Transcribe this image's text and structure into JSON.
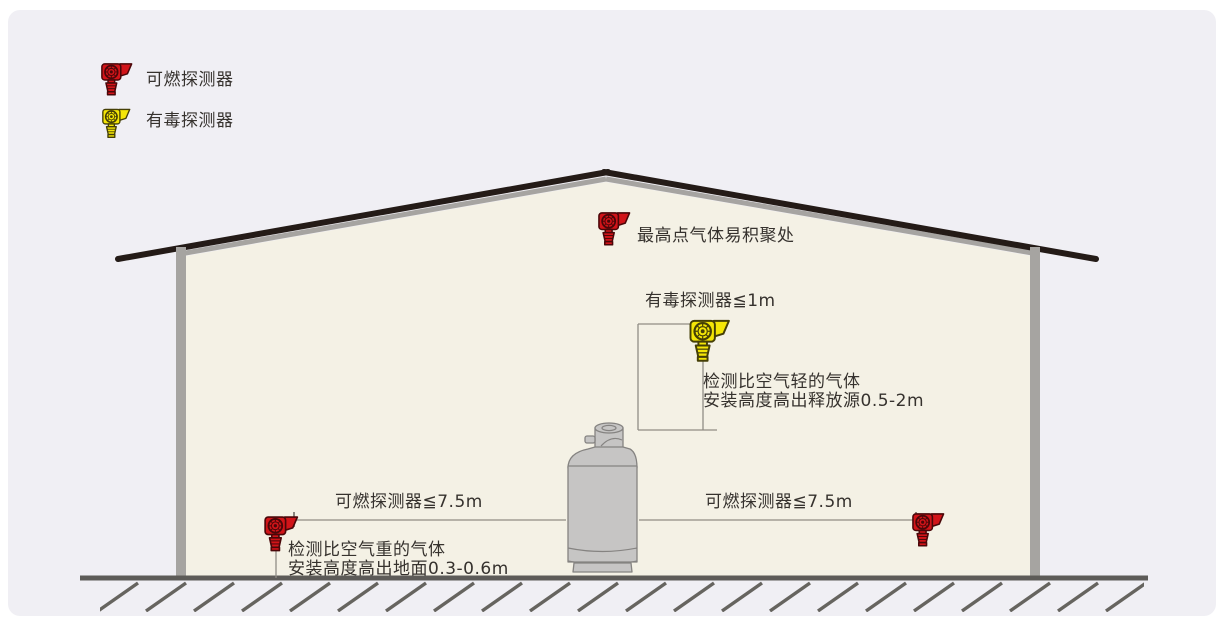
{
  "legend": {
    "combustible_label": "可燃探测器",
    "toxic_label": "有毒探测器"
  },
  "labels": {
    "peak_note": "最高点气体易积聚处",
    "toxic_detector_distance": "有毒探测器≦1m",
    "light_gas_note_line1": "检测比空气轻的气体",
    "light_gas_note_line2": "安装高度高出释放源0.5-2m",
    "combustible_distance_left": "可燃探测器≦7.5m",
    "combustible_distance_right": "可燃探测器≦7.5m",
    "heavy_gas_note_line1": "检测比空气重的气体",
    "heavy_gas_note_line2": "安装高度高出地面0.3-0.6m"
  },
  "colors": {
    "combustible_detector": "#d11419",
    "toxic_detector": "#f4e606",
    "roof": "#241b17",
    "wall": "#a6a4a1",
    "interior": "#f4f1e5",
    "background": "#f0eff4",
    "ground": "#5d5b58"
  }
}
